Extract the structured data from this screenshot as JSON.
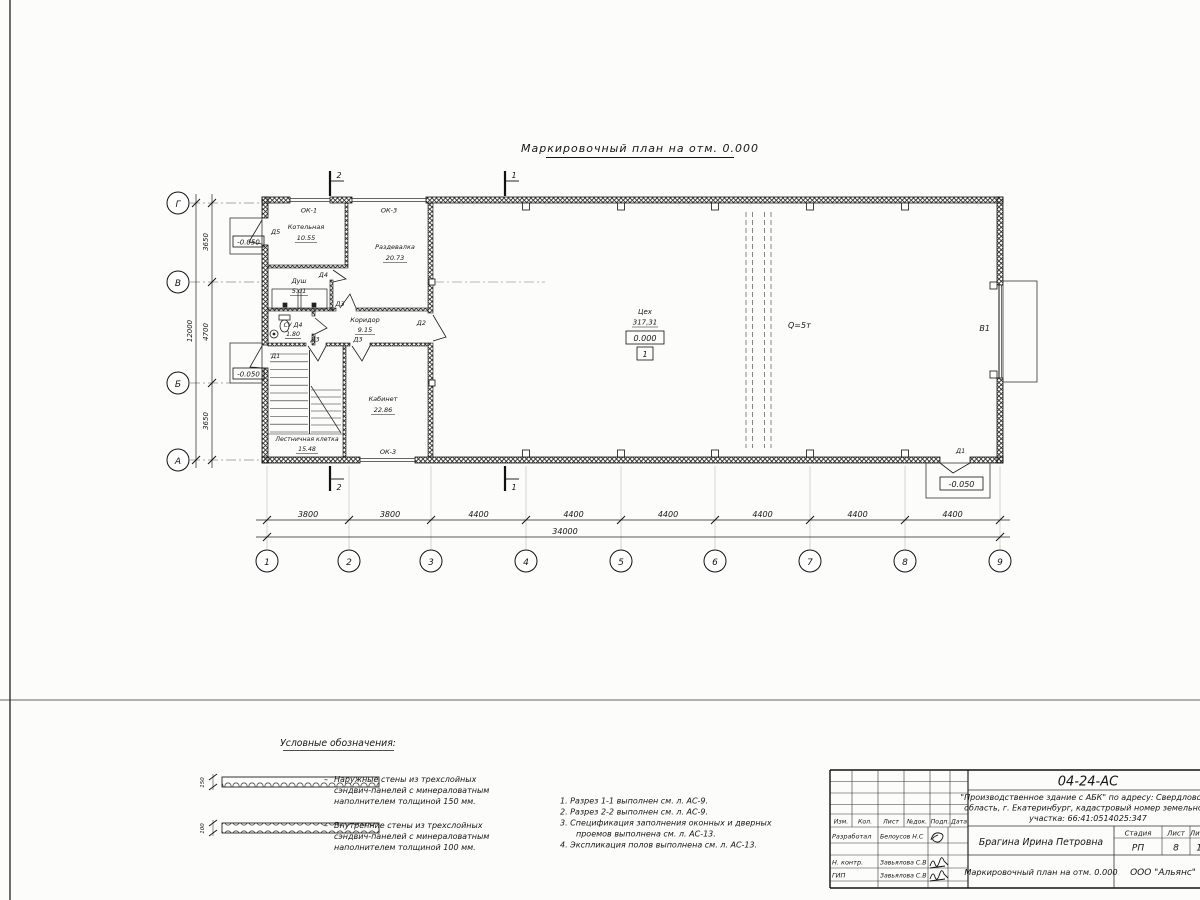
{
  "sheet": {
    "plan_title": "Маркировочный план на отм. 0.000"
  },
  "plan": {
    "axes_h": [
      "1",
      "2",
      "3",
      "4",
      "5",
      "6",
      "7",
      "8",
      "9"
    ],
    "axes_v": [
      "Г",
      "В",
      "Б",
      "А"
    ],
    "dims_bottom": [
      "3800",
      "3800",
      "4400",
      "4400",
      "4400",
      "4400",
      "4400",
      "4400"
    ],
    "dim_bottom_total": "34000",
    "dims_left": [
      "3650",
      "4700",
      "3650"
    ],
    "dim_left_total": "12000",
    "rooms": {
      "kotelnaya": {
        "name": "Котельная",
        "area": "10.55"
      },
      "razdevalka": {
        "name": "Раздевалка",
        "area": "20.73"
      },
      "dush": {
        "name": "Душ",
        "area": "5.01"
      },
      "su": {
        "name": "СУ Д4",
        "area": "1.80"
      },
      "koridor": {
        "name": "Коридор",
        "area": "9.15"
      },
      "kabinet": {
        "name": "Кабинет",
        "area": "22.86"
      },
      "lestnichnaya": {
        "name": "Лестничная клетка",
        "area": "15.48"
      },
      "tseh": {
        "name": "Цех",
        "area": "317,31",
        "level": "0.000",
        "floor_type": "1"
      }
    },
    "crane_label": "Q=5т",
    "gate_label": "В1",
    "level_outside": "-0.050",
    "doors": {
      "d1": "Д1",
      "d2": "Д2",
      "d3": "Д3",
      "d4": "Д4",
      "d5": "Д5"
    },
    "windows": {
      "ok1": "ОК-1",
      "ok3": "ОК-3"
    },
    "sections": {
      "s1": "1",
      "s2": "2"
    }
  },
  "legend": {
    "title": "Условные обозначения:",
    "dash": "–",
    "items": [
      {
        "thickness": "150",
        "lines": [
          "Наружные стены из трехслойных",
          "сэндвич-панелей с минераловатным",
          "наполнителем толщиной 150 мм."
        ]
      },
      {
        "thickness": "100",
        "lines": [
          "Внутренние стены из трехслойных",
          "сэндвич-панелей с минераловатным",
          "наполнителем толщиной 100 мм."
        ]
      }
    ]
  },
  "notes": {
    "lines": [
      "1. Разрез 1-1 выполнен см. л. АС-9.",
      "2. Разрез 2-2 выполнен см. л. АС-9.",
      "3. Спецификация заполнения оконных и дверных",
      "проемов выполнена см. л. АС-13.",
      "4. Экспликация полов выполнена см. л. АС-13."
    ]
  },
  "titleblock": {
    "doc_number": "04-24-АС",
    "project_lines": [
      "\"Производственное здание с АБК\" по адресу: Свердловская",
      "область, г. Екатеринбург, кадастровый номер земельного",
      "участка: 66:41:0514025:347"
    ],
    "header_cols": [
      "Изм.",
      "Кол.",
      "Лист",
      "№док.",
      "Подп.",
      "Дата"
    ],
    "signers": [
      {
        "role": "Разработал",
        "name": "Белоусов Н.С"
      },
      {
        "role": "Н. контр.",
        "name": "Завьялова С.В"
      },
      {
        "role": "ГИП",
        "name": "Завьялова С.В"
      }
    ],
    "approver": "Брагина Ирина Петровна",
    "sheet_title": "Маркировочный план на отм. 0.000",
    "stage_col": {
      "label": "Стадия",
      "value": "РП"
    },
    "sheet_col": {
      "label": "Лист",
      "value": "8"
    },
    "sheets_col": {
      "label": "Листов",
      "value": "13"
    },
    "company": "ООО \"Альянс\""
  }
}
